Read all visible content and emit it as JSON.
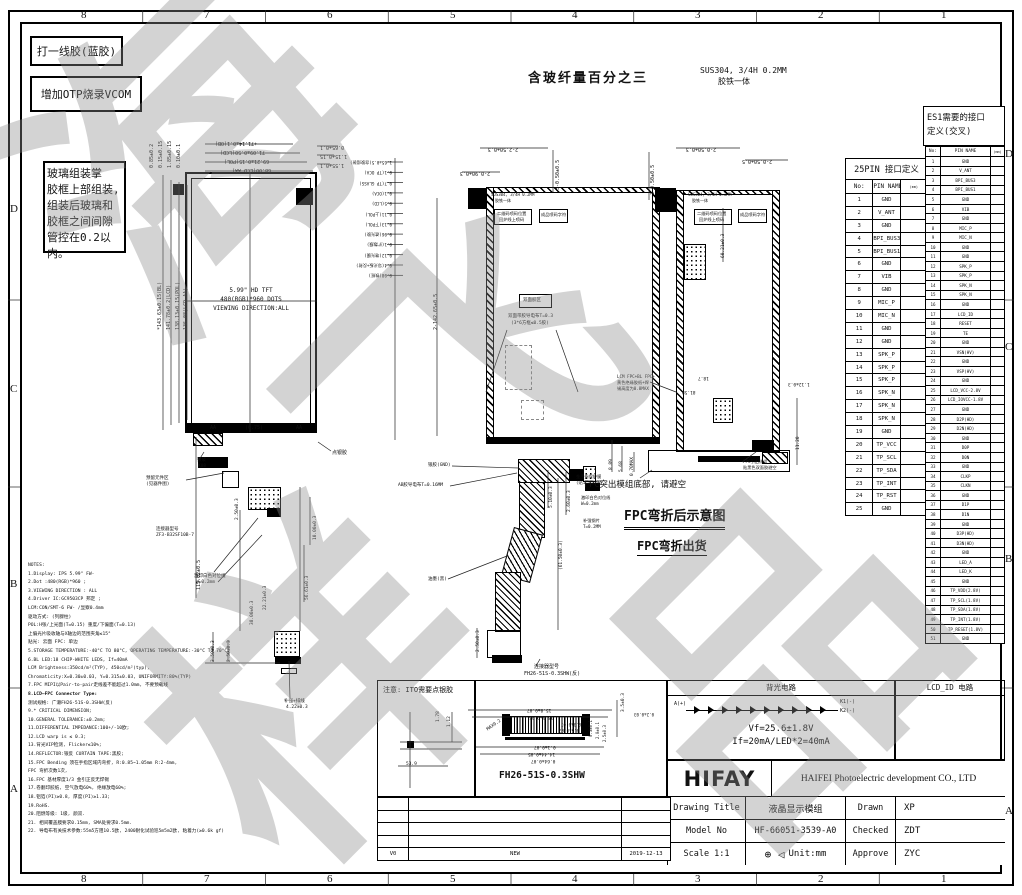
{
  "sheet": {
    "cols": [
      "8",
      "7",
      "6",
      "5",
      "4",
      "3",
      "2",
      "1"
    ],
    "rows_left": [
      "D",
      "C",
      "B",
      "A"
    ],
    "rows_right": [
      "D",
      "C",
      "B",
      "A"
    ],
    "watermark_chars": [
      "海",
      "飞",
      "样",
      "品"
    ]
  },
  "callout_boxes": {
    "note1": "打一线胶(蓝胶)",
    "note2": "增加OTP烧录VCOM",
    "note3": [
      "玻璃组装掌",
      "胶框上部组装,",
      "组装后玻璃和",
      "胶框之间间隙",
      "管控在0.2以内。"
    ],
    "fiber_note": "含玻纤量百分之三",
    "material": [
      "SUS304, 3/4H 0.2MM",
      "胶铁一体"
    ]
  },
  "fpc_labels": {
    "bend_title": "FPC弯折后示意图",
    "bend_ship": "FPC弯折出货",
    "protrude_note": "FPC突出模组底部, 请避空"
  },
  "d1_texts": [
    "+71.14±0.1(OB)",
    "71.09±0.50(LCD)",
    "69.21±0.15(POL)",
    "68.00(LCD AA)",
    "0.65±0.1",
    "1.15±0.15",
    "1.55±0.1",
    "0.85±0.2",
    "0.15±0.15",
    "1.85±0.15",
    "0.10±0.1",
    "*143.63±0.15(BL)",
    "141.78±0.2(LCD)",
    "138.13±0.15(POL)",
    "136.08(LCD AA)",
    "115.02±0.5",
    "5.99\" HD TFT",
    "480(RGB)*960 DOTS",
    "VIEWING DIRECTION:ALL",
    "银浆",
    "K08",
    "预留元件区",
    "(见器件图)",
    "连接器型号",
    "ZF3-B32SF10B-7",
    "2.50±0.3",
    "10.00±0.3",
    "56.61±0.3",
    "22.21±0.3",
    "38.00±0.3",
    "3.50±0.3",
    "2.50±0.3",
    "激印白色对位线",
    "W=0.2mm",
    "点银胶",
    "补强+排线",
    "4.22±0.3",
    "AA",
    "(0.75)",
    "AA"
  ],
  "d2_texts": [
    "1.65±0.5(含胶组装)",
    "0.1(TP OCA)",
    "0.7(TP GLASS)",
    "0.1(OCA)",
    "0.5(LCD)",
    "0.11(上POL)",
    "0.13(下POL)",
    "0.06(遮光胶)",
    "0.1(扩散膜)",
    "0.12(增光膜)",
    "0.4(导光板+反射)",
    "0.08(铁框)",
    "2-2.50±0.3",
    "2-0.90±0.3",
    "3-0.50±0.5",
    "2-142.65±0.5",
    "SUS304, 3/4H 0.2MM",
    "胶铁一体",
    "二维码喷码位置",
    "回炉线上喷码",
    "成品喷码字符",
    "双面胶区",
    "双面带胶导电布T=0.3",
    "(3*6方框≤0.5胶)",
    "银胶(GND)",
    "AB胶导电布T=0.16MM",
    "油墨(黑)",
    "2.50±0.3",
    "(61.50±0.3)",
    "5.10±0.3",
    "2.60±0.3",
    "连接器型号",
    "FH26-51S-0.3SHW(反)",
    "金手指保护膜",
    "(贴1:离型膜)",
    "激印白色对位线",
    "W=0.2mm",
    "补强钢片",
    "T=0.2MM"
  ],
  "d3_texts": [
    "2-0.50±0.3",
    "2-0.50±0.5",
    "3-0.50±0.5",
    "60.21±0.3",
    "SUS304, 3/4H 0.2MM",
    "胶铁一体",
    "二维码喷码位置",
    "回炉线上喷码",
    "成品喷码字符",
    "18.7",
    "81.58",
    "1.12±0.3",
    "LCM FPC+BL FPC+",
    "黄色绝缘胶纸+焊",
    "锡高度为0.8MAX",
    "8.89",
    "5.68",
    "0.70MAX",
    "11.20",
    "FPC引出线组",
    "贴黑色双面胶避空"
  ],
  "ito_box": {
    "title": "注意: ITO需要点银胶",
    "dims": [
      "1.78",
      "1.12",
      "53.9"
    ]
  },
  "connector_box": {
    "part": "FH26-51S-0.3SHW",
    "dims": [
      "15.8±0.07",
      "15.0±0.05",
      "0.3±0.07",
      "0.5±0.07",
      "MAX0.2",
      "0.1±0.07",
      "14.44±0.05",
      "0.64±0.07",
      "3.5±0.3",
      "0.2±0.03",
      "0.3±0.1",
      "2.0±0.1",
      "2.5±0.3"
    ]
  },
  "revision_table": {
    "rows": [
      [
        "",
        "",
        ""
      ],
      [
        "",
        "",
        ""
      ],
      [
        "",
        "",
        ""
      ],
      [
        "",
        "",
        ""
      ],
      [
        "V0",
        "NEW",
        "2019-12-13"
      ]
    ]
  },
  "backlight": {
    "title": "背光电路",
    "lcd_id_title": "LCD_ID 电路",
    "anode": "A(+)",
    "k1": "K1(-)",
    "k2": "K2(-)",
    "vf": "Vf=25.6±1.8V",
    "if": "If=20mA/LED*2=40mA"
  },
  "title_block": {
    "logo": "HIFAY",
    "company": "HAIFEI Photoelectric development CO., LTD",
    "projection_symbols": "⊕ ◁",
    "rows": [
      {
        "label": "Drawing Title",
        "value": "液晶显示模组",
        "label2": "Drawn",
        "value2": "XP"
      },
      {
        "label": "Model No",
        "value": "HF-66051-3539-A0",
        "label2": "Checked",
        "value2": "ZDT"
      },
      {
        "label": "Scale 1:1",
        "value": "Unit:mm",
        "label2": "Approve",
        "value2": "ZYC"
      }
    ]
  },
  "pin_table_25": {
    "title": "25PIN 接口定义",
    "headers": [
      "No:",
      "PIN NAME",
      "(mm)"
    ],
    "rows": [
      [
        "1",
        "GND"
      ],
      [
        "2",
        "V_ANT"
      ],
      [
        "3",
        "GND"
      ],
      [
        "4",
        "BPI_BUS3"
      ],
      [
        "5",
        "BPI_BUS1"
      ],
      [
        "6",
        "GND"
      ],
      [
        "7",
        "VIB"
      ],
      [
        "8",
        "GND"
      ],
      [
        "9",
        "MIC_P"
      ],
      [
        "10",
        "MIC_N"
      ],
      [
        "11",
        "GND"
      ],
      [
        "12",
        "GND"
      ],
      [
        "13",
        "SPK_P"
      ],
      [
        "14",
        "SPK_P"
      ],
      [
        "15",
        "SPK_P"
      ],
      [
        "16",
        "SPK_N"
      ],
      [
        "17",
        "SPK_N"
      ],
      [
        "18",
        "SPK_N"
      ],
      [
        "19",
        "GND"
      ],
      [
        "20",
        "TP_VCC"
      ],
      [
        "21",
        "TP_SCL"
      ],
      [
        "22",
        "TP_SDA"
      ],
      [
        "23",
        "TP_INT"
      ],
      [
        "24",
        "TP_RST"
      ],
      [
        "25",
        "GND"
      ]
    ]
  },
  "pin_table_es1": {
    "title": "ES1需要的接口",
    "title2": "定义(交叉)",
    "headers": [
      "No:",
      "PIN NAME",
      "(mm)"
    ],
    "rows": [
      [
        "1",
        "GND"
      ],
      [
        "2",
        "V_ANT"
      ],
      [
        "3",
        "BPI_BUS3"
      ],
      [
        "4",
        "BPI_BUS1"
      ],
      [
        "5",
        "GND"
      ],
      [
        "6",
        "VIB"
      ],
      [
        "7",
        "GND"
      ],
      [
        "8",
        "MIC_P"
      ],
      [
        "9",
        "MIC_N"
      ],
      [
        "10",
        "GND"
      ],
      [
        "11",
        "GND"
      ],
      [
        "12",
        "SPK_P"
      ],
      [
        "13",
        "SPK_P"
      ],
      [
        "14",
        "SPK_N"
      ],
      [
        "15",
        "SPK_N"
      ],
      [
        "16",
        "GND"
      ],
      [
        "17",
        "LCD_ID"
      ],
      [
        "18",
        "RESET"
      ],
      [
        "19",
        "TE"
      ],
      [
        "20",
        "GND"
      ],
      [
        "21",
        "VSN(HV)"
      ],
      [
        "22",
        "GND"
      ],
      [
        "23",
        "VSP(HV)"
      ],
      [
        "24",
        "GND"
      ],
      [
        "25",
        "LCD_VCC-2.8V"
      ],
      [
        "26",
        "LCD_IOVCC-1.8V"
      ],
      [
        "27",
        "GND"
      ],
      [
        "28",
        "D2P(HD)"
      ],
      [
        "29",
        "D2N(HD)"
      ],
      [
        "30",
        "GND"
      ],
      [
        "31",
        "D0P"
      ],
      [
        "32",
        "D0N"
      ],
      [
        "33",
        "GND"
      ],
      [
        "34",
        "CLKP"
      ],
      [
        "35",
        "CLKN"
      ],
      [
        "36",
        "GND"
      ],
      [
        "37",
        "D1P"
      ],
      [
        "38",
        "D1N"
      ],
      [
        "39",
        "GND"
      ],
      [
        "40",
        "D3P(HD)"
      ],
      [
        "41",
        "D3N(HD)"
      ],
      [
        "42",
        "GND"
      ],
      [
        "43",
        "LED_A"
      ],
      [
        "44",
        "LED_K"
      ],
      [
        "45",
        "GND"
      ],
      [
        "46",
        "TP_VDD(2.8V)"
      ],
      [
        "47",
        "TP_SCL(1.8V)"
      ],
      [
        "48",
        "TP_SDA(1.8V)"
      ],
      [
        "49",
        "TP_INT(1.8V)"
      ],
      [
        "50",
        "TP_RESET(1.8V)"
      ],
      [
        "51",
        "GND"
      ]
    ]
  },
  "notes": {
    "lines": [
      "NOTES:",
      "1.Display: IPS 5.99\" FW-",
      "2.Dot :480(RGB)*960 ;",
      "3.VIEWING DIRECTION : ALL",
      "4.Driver IC:GC9503CP 邦定 ;",
      "LCM:CON/SMT-6 FW- /显察0.4mm",
      "驱动方式: (列腺柱)",
      "  POL:H张/上光面(T=0.15)  重度/下偏面(T=0.13)",
      "  上偏光片吸收轴与X轴边的范围夹角≤15°",
      "  贴光: 云面  FPC: 单边",
      "5.STORAGE TEMPERATURE:-40°C TO 80°C, OPERATING TEMPERATURE:-30°C TO 70°C;",
      "6.BL LED:18 CHIP-WHITE LEDS, If=40mA",
      "LCM Brightness:350cd/m²(TYP), 450cd/m²(typ),",
      "  Chromaticity:X=0.30±0.03, Y=0.315±0.03, UNIFORMITY:80%(TYP)",
      "7.FPC MIPI以Pair-to-pair走线差不能超过1.0mm, 不要预载线",
      "8.LCD—FPC Connector Type:",
      "  测试规格: 广濑FH26-51S-0.3SHW(反)",
      "9.* CRITICAL DIMENSION;",
      "10.GENERAL TOLERANCE:±0.2mm;",
      "11.DIFFERENTIAL IMPEDANCE:100+/-10欧;",
      "12.LCD warp is ≤ 0.3;",
      "13.背光VIP检测, Flicker≤10%;",
      "14.REFLECTOR:银反  CURTAIN TAPE:黑胶;",
      "15.FPC Bending 须在手指区域内弯折, R:0.85~1.05mm  R:2-4mm,",
      "FPC 弯折次数1次,",
      "16.FPC 基材厚度1/3 金引正反无焊锡",
      "17.卷翻印胶纸, 空气放电60%, 绝缘放电60%;",
      "18.铝箔(PI)≥0.8, 厚度(PI)≥1.33;",
      "19.RoHS.",
      "20.阻燃等级: 1级, 颜双.",
      "21. 相间覆盖膜要求0.15mm, SMA处要求0.5mm.",
      "22. 导电布有关技术参数:55m5方阻10.5欧, 2400耐化试验巡5m5m2欧, 粘着力(≥0.6k gf)"
    ]
  }
}
